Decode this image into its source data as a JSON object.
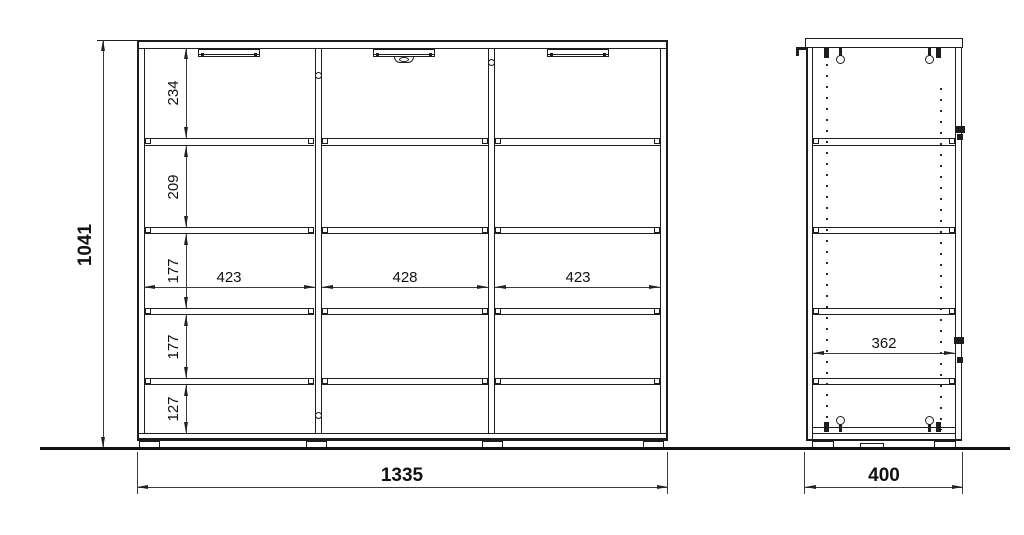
{
  "dims": {
    "height_total": "1041",
    "width_total": "1335",
    "depth_total": "400",
    "depth_inner": "362",
    "row_heights": [
      "234",
      "209",
      "177",
      "177",
      "127"
    ],
    "col_widths": [
      "423",
      "428",
      "423"
    ]
  }
}
